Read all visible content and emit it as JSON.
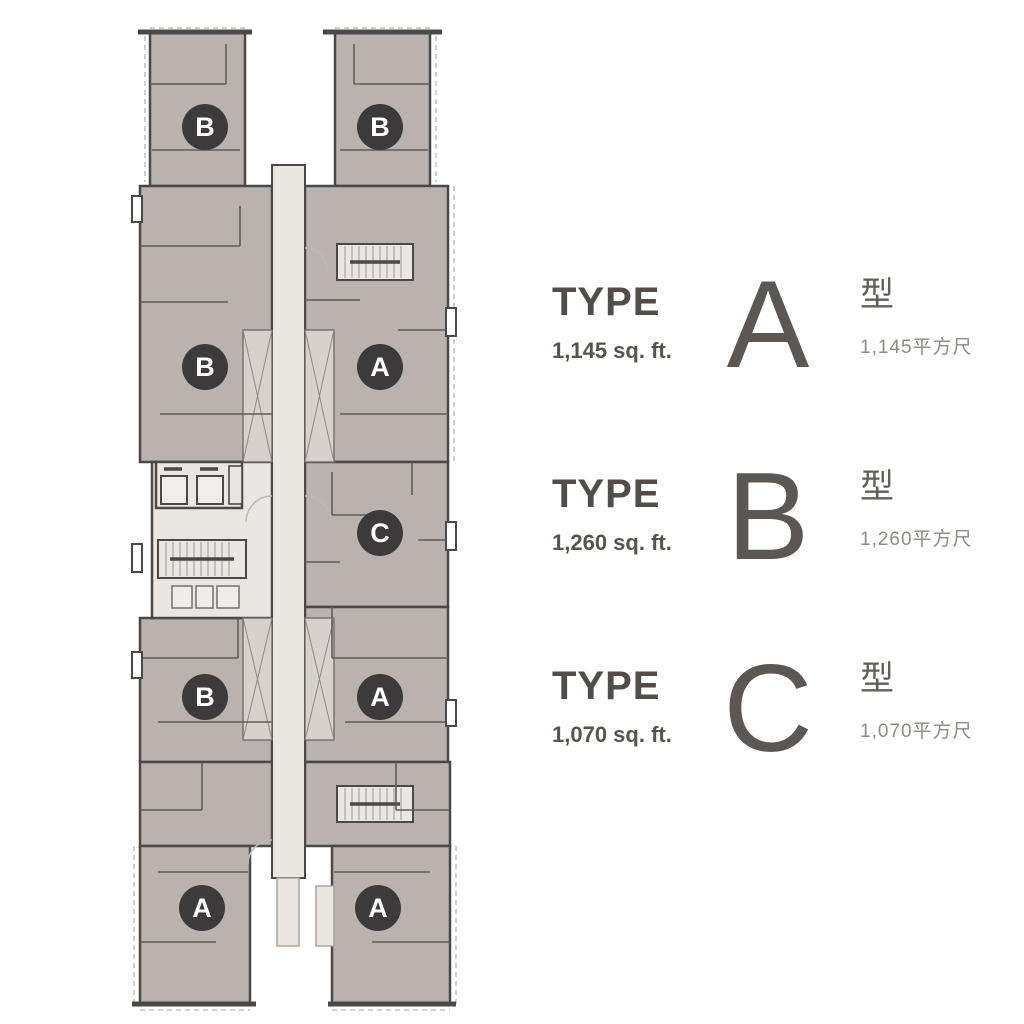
{
  "floor_plan": {
    "description": "Tower floor plan with two wings, central corridor, lift core and three stairs",
    "colors": {
      "unit_fill": "#b9b2ae",
      "corridor_fill": "#eae7e3",
      "shaft_fill": "#d6d1cd",
      "wall": "#4b4848",
      "marker_bg": "#3c3a3a",
      "marker_text": "#ffffff"
    },
    "markers": [
      {
        "letter": "B",
        "x": 205,
        "y": 127
      },
      {
        "letter": "B",
        "x": 380,
        "y": 127
      },
      {
        "letter": "B",
        "x": 205,
        "y": 367
      },
      {
        "letter": "A",
        "x": 380,
        "y": 367
      },
      {
        "letter": "C",
        "x": 380,
        "y": 533
      },
      {
        "letter": "B",
        "x": 205,
        "y": 697
      },
      {
        "letter": "A",
        "x": 380,
        "y": 697
      },
      {
        "letter": "A",
        "x": 202,
        "y": 908
      },
      {
        "letter": "A",
        "x": 378,
        "y": 908
      }
    ]
  },
  "legend": {
    "entries": [
      {
        "type_word": "TYPE",
        "letter": "A",
        "area_en": "1,145 sq. ft.",
        "type_cn": "型",
        "area_cn": "1,145平方尺"
      },
      {
        "type_word": "TYPE",
        "letter": "B",
        "area_en": "1,260 sq. ft.",
        "type_cn": "型",
        "area_cn": "1,260平方尺"
      },
      {
        "type_word": "TYPE",
        "letter": "C",
        "area_en": "1,070 sq. ft.",
        "type_cn": "型",
        "area_cn": "1,070平方尺"
      }
    ]
  }
}
